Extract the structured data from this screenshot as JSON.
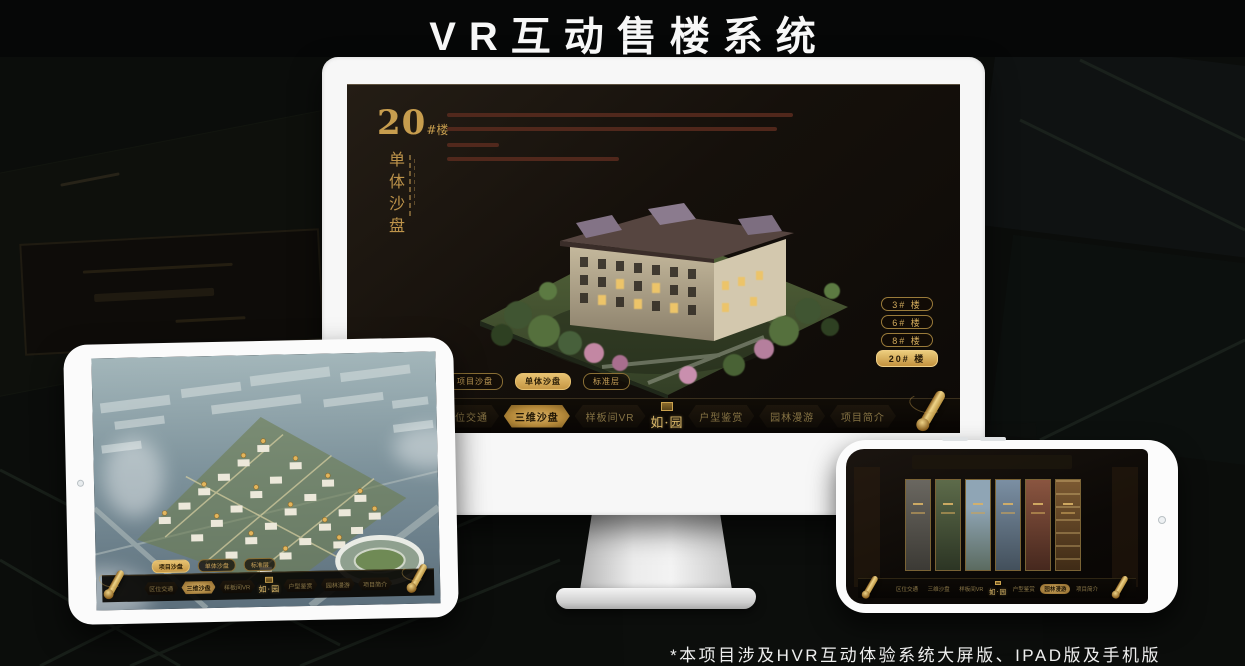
{
  "page": {
    "title": "VR互动售楼系统",
    "footnote": "*本项目涉及HVR互动体验系统大屏版、IPAD版及手机版"
  },
  "colors": {
    "gold": "#C9A24F",
    "gold_bright": "#E7C271",
    "screen_background": "#15100B",
    "title_white": "#F7F7F7"
  },
  "app": {
    "logo": "如·园",
    "nav_items": [
      "区位交通",
      "三维沙盘",
      "样板间VR",
      "户型鉴赏",
      "园林漫游",
      "项目简介"
    ],
    "sub_tabs": [
      "项目沙盘",
      "单体沙盘",
      "标准层"
    ]
  },
  "monitor": {
    "heading_number": "20",
    "heading_unit": "#楼",
    "heading_caption": "单体沙盘",
    "building_buttons": [
      "3# 楼",
      "6# 楼",
      "8# 楼",
      "20# 楼"
    ],
    "active_building_button": "20# 楼",
    "active_sub_tab": "单体沙盘",
    "active_nav_item": "三维沙盘"
  },
  "tablet": {
    "active_sub_tab": "项目沙盘",
    "active_nav_item": "三维沙盘"
  },
  "phone": {
    "active_nav_item": "园林漫游",
    "gallery_panel_count": "6"
  }
}
